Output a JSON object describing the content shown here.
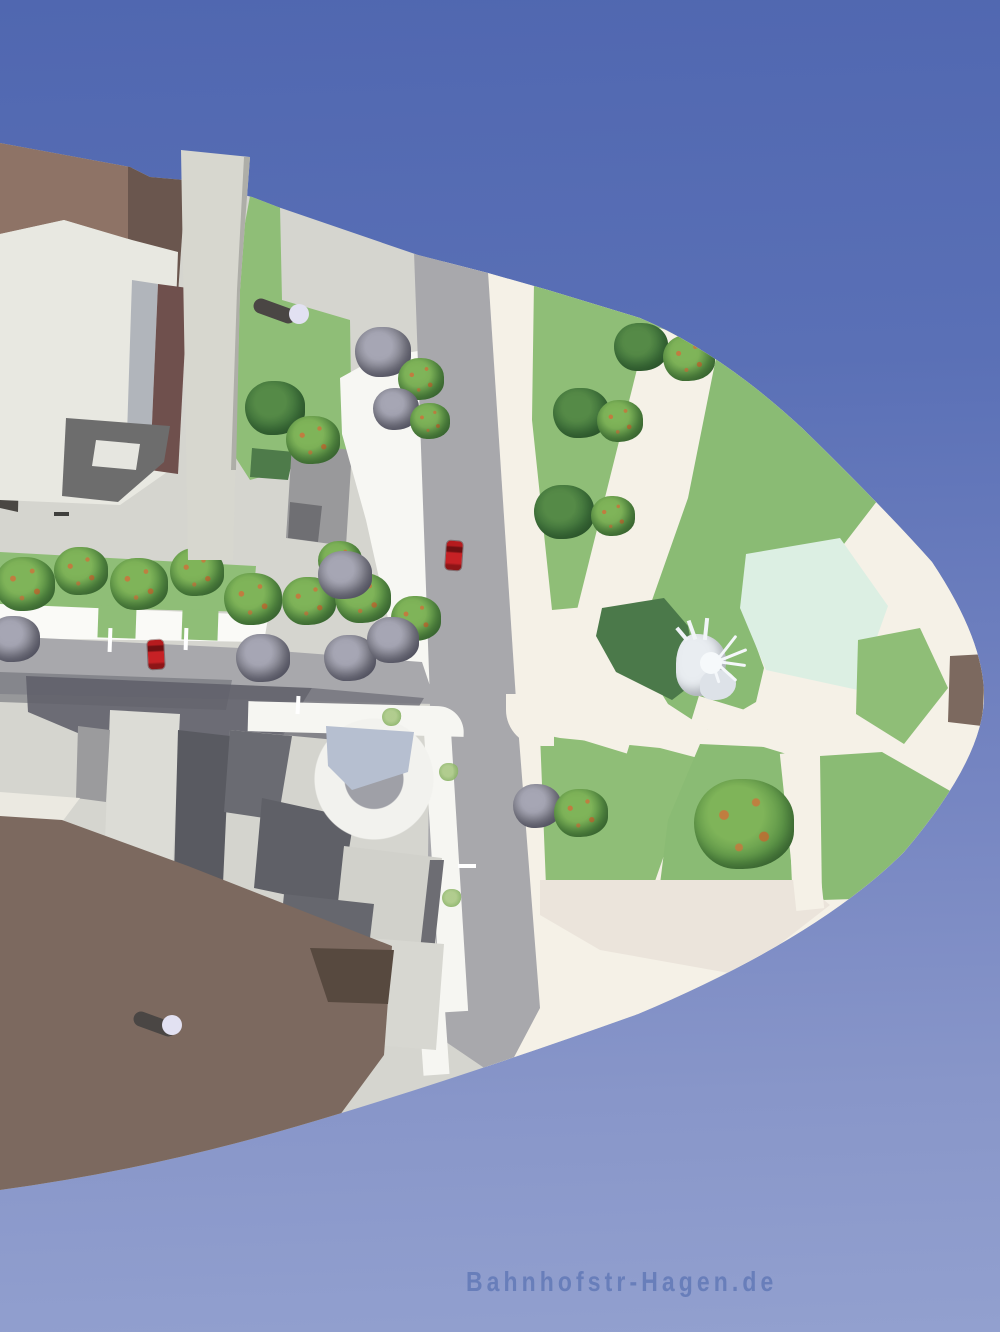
{
  "watermark": {
    "text": "Bahnhofstr-Hagen.de",
    "color": "#687eba"
  },
  "sky": {
    "top": "#5067b0",
    "bottom": "#92a0cf"
  },
  "palette": {
    "pavement": "#d5d5cf",
    "plaza_cream": "#f5f1e7",
    "plaza_shade": "#ebe4db",
    "road": "#a8a8ac",
    "sidewalk_white": "#f6f6f2",
    "parking_white": "#fafaf7",
    "lawn": "#8fbe77",
    "lawn_dark": "#4e7b4a",
    "pond": "#dcefe3",
    "roof_light": "#d4d4ce",
    "facade_white": "#e8e8e1",
    "shadow_dark": "#60616a",
    "brown_light": "#8e7366",
    "brown_dark": "#6a564e",
    "ground_brown": "#7c695f",
    "ground_brown_dark": "#57493f",
    "charcoal": "#4a4743",
    "skylight_silver": "#b1b5bb",
    "skylight_maroon": "#6f504d",
    "glass_blue": "#b6bfd0",
    "car_red": "#c62125",
    "pillar_cap": "#e2e1f2",
    "sculpture_white": "#e9edf1",
    "tree_orange_dots": "#c47a3e"
  },
  "trees": [
    {
      "type": "dkgreen",
      "x": 275,
      "y": 408,
      "r": 30
    },
    {
      "type": "orange",
      "x": 313,
      "y": 440,
      "r": 27
    },
    {
      "type": "gray",
      "x": 383,
      "y": 352,
      "r": 28
    },
    {
      "type": "orange",
      "x": 421,
      "y": 379,
      "r": 23
    },
    {
      "type": "gray",
      "x": 396,
      "y": 409,
      "r": 23
    },
    {
      "type": "orange",
      "x": 430,
      "y": 421,
      "r": 20
    },
    {
      "type": "dkgreen",
      "x": 641,
      "y": 347,
      "r": 27
    },
    {
      "type": "orange",
      "x": 689,
      "y": 358,
      "r": 26
    },
    {
      "type": "dkgreen",
      "x": 581,
      "y": 413,
      "r": 28
    },
    {
      "type": "orange",
      "x": 620,
      "y": 421,
      "r": 23
    },
    {
      "type": "dkgreen",
      "x": 564,
      "y": 512,
      "r": 30
    },
    {
      "type": "orange",
      "x": 613,
      "y": 516,
      "r": 22
    },
    {
      "type": "gray",
      "x": 537,
      "y": 806,
      "r": 24
    },
    {
      "type": "orange",
      "x": 581,
      "y": 813,
      "r": 27
    },
    {
      "type": "orange",
      "x": 744,
      "y": 824,
      "r": 50
    },
    {
      "type": "orange",
      "x": 25,
      "y": 584,
      "r": 30
    },
    {
      "type": "orange",
      "x": 81,
      "y": 571,
      "r": 27
    },
    {
      "type": "orange",
      "x": 139,
      "y": 584,
      "r": 29
    },
    {
      "type": "orange",
      "x": 197,
      "y": 572,
      "r": 27
    },
    {
      "type": "orange",
      "x": 253,
      "y": 599,
      "r": 29
    },
    {
      "type": "orange",
      "x": 309,
      "y": 601,
      "r": 27
    },
    {
      "type": "orange",
      "x": 340,
      "y": 561,
      "r": 22
    },
    {
      "type": "orange",
      "x": 363,
      "y": 598,
      "r": 28
    },
    {
      "type": "orange",
      "x": 416,
      "y": 618,
      "r": 25
    },
    {
      "type": "gray",
      "x": 345,
      "y": 575,
      "r": 27
    },
    {
      "type": "gray",
      "x": 263,
      "y": 658,
      "r": 27
    },
    {
      "type": "gray",
      "x": 350,
      "y": 658,
      "r": 26
    },
    {
      "type": "gray",
      "x": 393,
      "y": 640,
      "r": 26
    },
    {
      "type": "gray",
      "x": 14,
      "y": 639,
      "r": 26
    },
    {
      "type": "bush",
      "x": 392,
      "y": 717,
      "r": 10
    },
    {
      "type": "bush",
      "x": 449,
      "y": 772,
      "r": 10
    },
    {
      "type": "bush",
      "x": 452,
      "y": 898,
      "r": 10
    }
  ],
  "cars": [
    {
      "x": 446,
      "y": 541,
      "angle": 4
    },
    {
      "x": 148,
      "y": 640,
      "angle": -3
    }
  ],
  "pillars": [
    {
      "x": 254,
      "y": 296,
      "len": 44,
      "angle": 20,
      "capX": 299,
      "capY": 314
    },
    {
      "x": 134,
      "y": 1009,
      "len": 44,
      "angle": 20,
      "capX": 172,
      "capY": 1025
    }
  ],
  "markings": [
    {
      "x": 296,
      "y": 696,
      "w": 4,
      "h": 18,
      "angle": 3,
      "color": "#ffffff"
    },
    {
      "x": 458,
      "y": 864,
      "w": 18,
      "h": 4,
      "angle": 0,
      "color": "#ffffff"
    },
    {
      "x": 108,
      "y": 628,
      "w": 4,
      "h": 24,
      "angle": 2,
      "color": "#ffffff"
    },
    {
      "x": 184,
      "y": 628,
      "w": 4,
      "h": 22,
      "angle": 2,
      "color": "#ffffff"
    },
    {
      "x": 54,
      "y": 512,
      "w": 15,
      "h": 4,
      "angle": 0,
      "color": "#3f3f3c"
    }
  ]
}
